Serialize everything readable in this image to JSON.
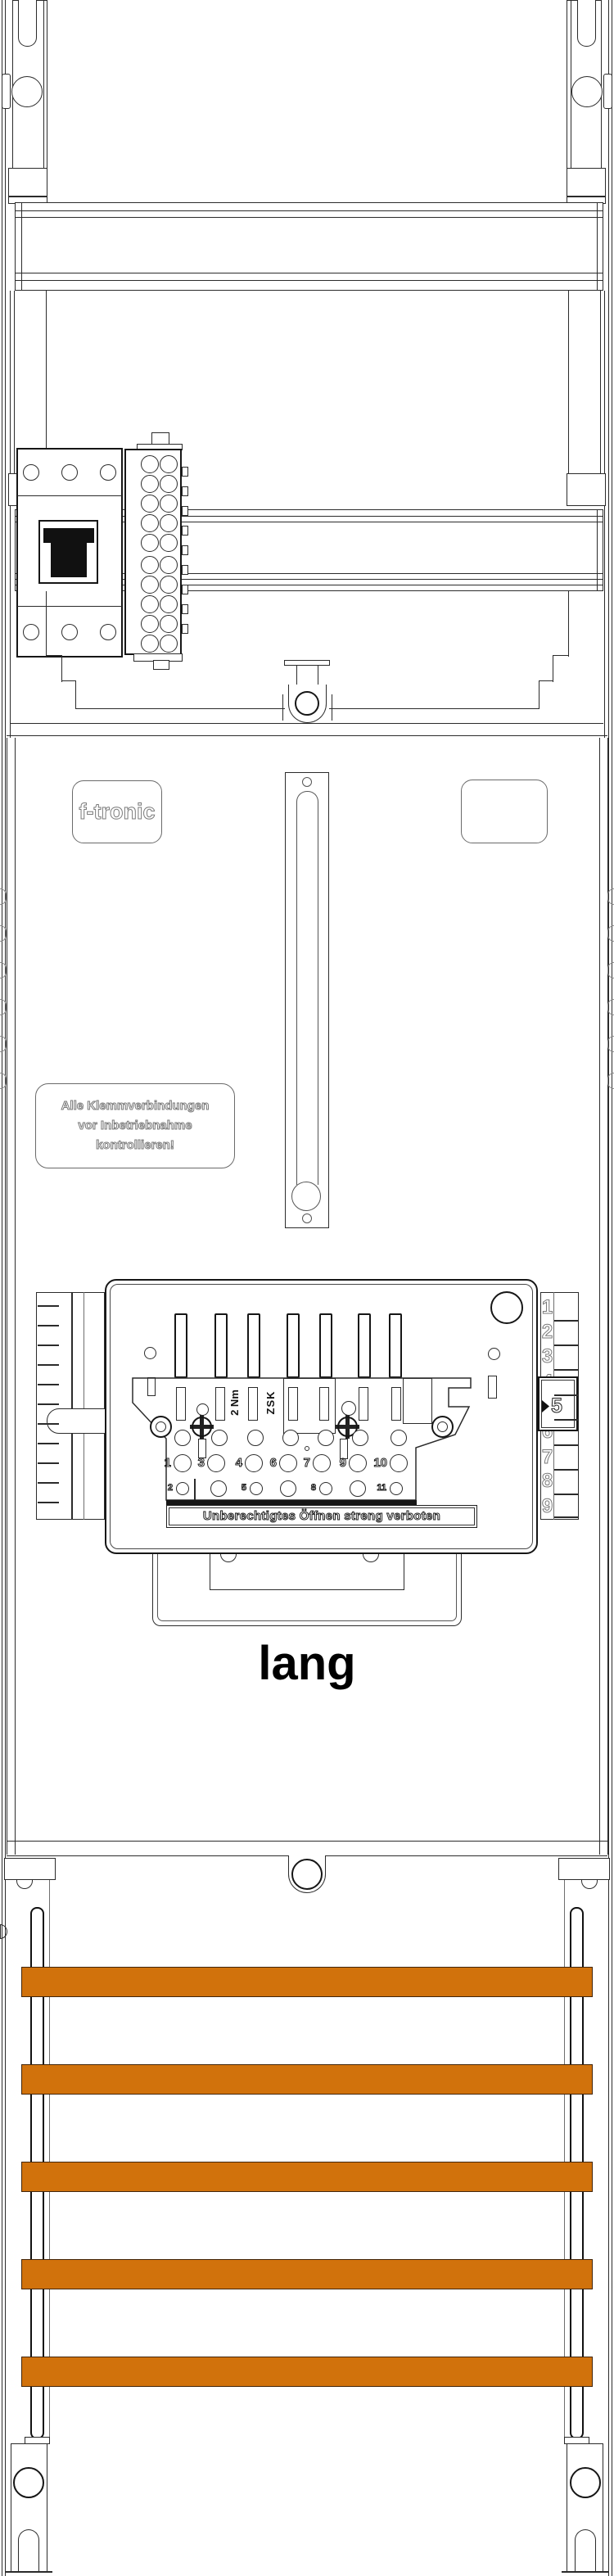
{
  "branding": {
    "logo_text": "f-tronic"
  },
  "panel": {
    "check_label": {
      "lines": [
        "Alle Klemmverbindungen",
        "vor Inbetriebnahme",
        "kontrollieren!"
      ]
    },
    "size_label": "lang"
  },
  "zsk_device": {
    "torque_label": "2 Nm",
    "type_label": "ZSK",
    "warning_label": "Unberechtigtes Öffnen streng verboten",
    "terminal_numbers_row1": [
      "1",
      "3",
      "4",
      "6",
      "7",
      "9",
      "10"
    ],
    "terminal_numbers_row2": [
      "2",
      "5",
      "8",
      "11"
    ],
    "depth_scale_numbers": [
      "1",
      "2",
      "3",
      "4",
      "5",
      "6",
      "7",
      "8",
      "9"
    ],
    "depth_pointer_value": "5"
  },
  "busbar_section": {
    "bar_count": 5
  },
  "colors": {
    "busbar_orange": "#d1720c",
    "line": "#2b2b2b"
  }
}
